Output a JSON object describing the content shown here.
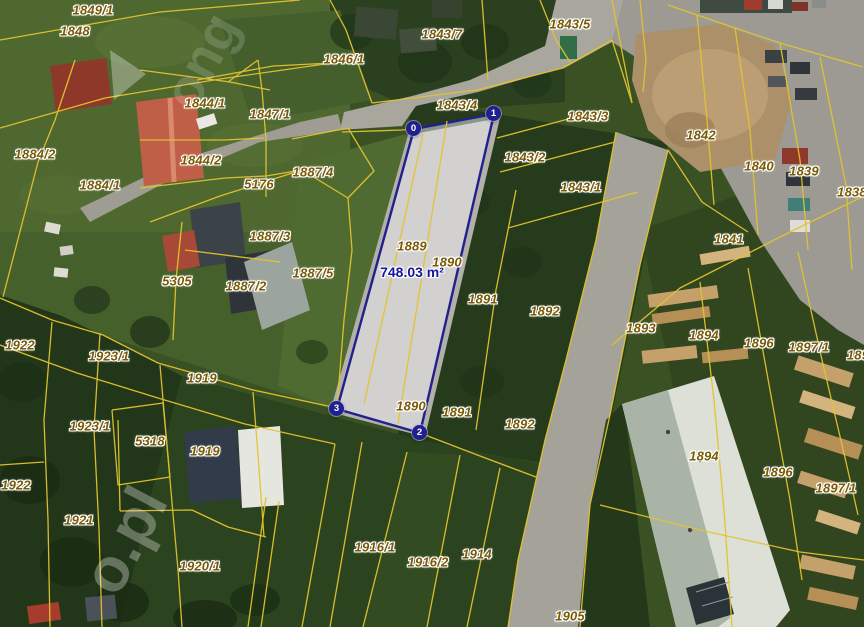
{
  "map": {
    "width": 864,
    "height": 627,
    "measurement": {
      "text": "748.03 m²",
      "x": 412,
      "y": 272
    },
    "vertices": [
      {
        "label": "0",
        "x": 414,
        "y": 129
      },
      {
        "label": "1",
        "x": 494,
        "y": 114
      },
      {
        "label": "2",
        "x": 420,
        "y": 433
      },
      {
        "label": "3",
        "x": 337,
        "y": 409
      }
    ],
    "parcel_labels": [
      {
        "text": "1849/1",
        "x": 93,
        "y": 10
      },
      {
        "text": "1848",
        "x": 75,
        "y": 31
      },
      {
        "text": "1846/1",
        "x": 344,
        "y": 59
      },
      {
        "text": "1843/7",
        "x": 442,
        "y": 34
      },
      {
        "text": "1843/5",
        "x": 570,
        "y": 24
      },
      {
        "text": "1844/1",
        "x": 205,
        "y": 103
      },
      {
        "text": "1847/1",
        "x": 270,
        "y": 114
      },
      {
        "text": "1843/4",
        "x": 457,
        "y": 105
      },
      {
        "text": "1843/3",
        "x": 588,
        "y": 116
      },
      {
        "text": "1842",
        "x": 701,
        "y": 135
      },
      {
        "text": "1884/2",
        "x": 35,
        "y": 154
      },
      {
        "text": "1844/2",
        "x": 201,
        "y": 160
      },
      {
        "text": "1843/2",
        "x": 525,
        "y": 157
      },
      {
        "text": "1840",
        "x": 759,
        "y": 166
      },
      {
        "text": "1839",
        "x": 804,
        "y": 171
      },
      {
        "text": "1884/1",
        "x": 100,
        "y": 185
      },
      {
        "text": "5176",
        "x": 259,
        "y": 184
      },
      {
        "text": "1887/4",
        "x": 313,
        "y": 172
      },
      {
        "text": "1843/1",
        "x": 581,
        "y": 187
      },
      {
        "text": "1838",
        "x": 852,
        "y": 192
      },
      {
        "text": "1887/3",
        "x": 270,
        "y": 236
      },
      {
        "text": "1841",
        "x": 729,
        "y": 239
      },
      {
        "text": "1889",
        "x": 412,
        "y": 246
      },
      {
        "text": "1890",
        "x": 447,
        "y": 262
      },
      {
        "text": "5305",
        "x": 177,
        "y": 281
      },
      {
        "text": "1887/2",
        "x": 246,
        "y": 286
      },
      {
        "text": "1887/5",
        "x": 313,
        "y": 273
      },
      {
        "text": "1891",
        "x": 483,
        "y": 299
      },
      {
        "text": "1892",
        "x": 545,
        "y": 311
      },
      {
        "text": "1893",
        "x": 641,
        "y": 328
      },
      {
        "text": "1894",
        "x": 704,
        "y": 335
      },
      {
        "text": "1896",
        "x": 759,
        "y": 343
      },
      {
        "text": "1897/1",
        "x": 809,
        "y": 347
      },
      {
        "text": "189",
        "x": 858,
        "y": 355
      },
      {
        "text": "1922",
        "x": 20,
        "y": 345
      },
      {
        "text": "1923/1",
        "x": 109,
        "y": 356
      },
      {
        "text": "1919",
        "x": 202,
        "y": 378
      },
      {
        "text": "1890",
        "x": 411,
        "y": 406
      },
      {
        "text": "1891",
        "x": 457,
        "y": 412
      },
      {
        "text": "1892",
        "x": 520,
        "y": 424
      },
      {
        "text": "1923/1",
        "x": 90,
        "y": 426
      },
      {
        "text": "5318",
        "x": 150,
        "y": 441
      },
      {
        "text": "1919",
        "x": 205,
        "y": 451
      },
      {
        "text": "1894",
        "x": 704,
        "y": 456
      },
      {
        "text": "1896",
        "x": 778,
        "y": 472
      },
      {
        "text": "1897/1",
        "x": 836,
        "y": 488
      },
      {
        "text": "1922",
        "x": 16,
        "y": 485
      },
      {
        "text": "1921",
        "x": 79,
        "y": 520
      },
      {
        "text": "1920/1",
        "x": 200,
        "y": 566
      },
      {
        "text": "1916/1",
        "x": 375,
        "y": 547
      },
      {
        "text": "1916/2",
        "x": 428,
        "y": 562
      },
      {
        "text": "1914",
        "x": 477,
        "y": 554
      },
      {
        "text": "1905",
        "x": 570,
        "y": 616
      }
    ],
    "watermarks": [
      {
        "text": "ong",
        "x": 152,
        "y": 30,
        "angle": -62,
        "opacity": 0.16,
        "size": 54
      },
      {
        "text": "o.pl",
        "x": 70,
        "y": 505,
        "angle": -62,
        "opacity": 0.3,
        "size": 62
      }
    ],
    "colors": {
      "parcel_line": "#e3c32e",
      "label": "#7a5a06",
      "selection": "#20208e",
      "selection_fill": "rgba(242,242,247,0.5)",
      "measure_text": "#15159e"
    }
  }
}
